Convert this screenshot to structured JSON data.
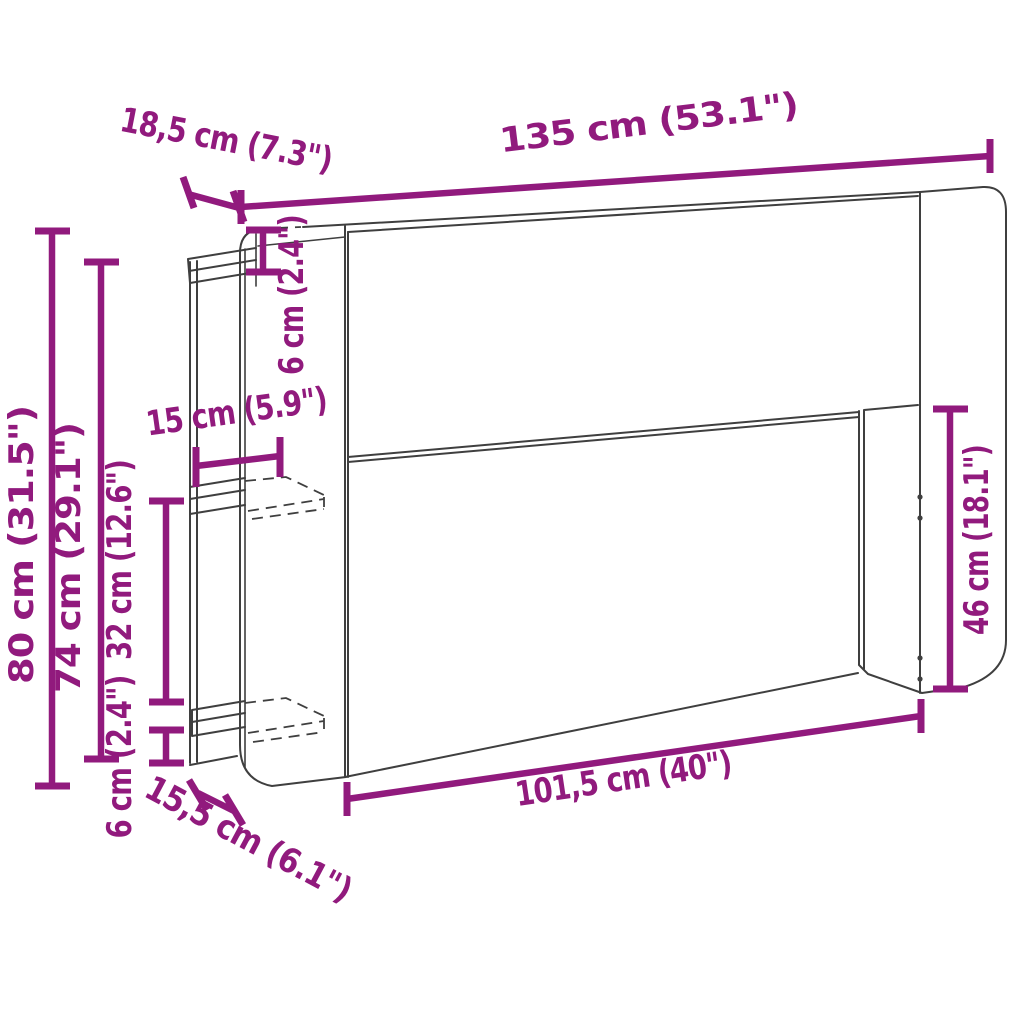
{
  "diagram": {
    "type": "furniture-dimension-diagram",
    "product": "headboard with storage shelves",
    "accent_color": "#911a7d",
    "outline_color": "#3f3f3f",
    "background_color": "#ffffff",
    "dimensions": {
      "overall_width": {
        "label": "135 cm (53.1\")",
        "cm": 135,
        "inches": 53.1
      },
      "top_depth": {
        "label": "18,5 cm (7.3\")",
        "cm": 18.5,
        "inches": 7.3
      },
      "top_thickness": {
        "label": "6 cm (2.4\")",
        "cm": 6,
        "inches": 2.4
      },
      "overall_height": {
        "label": "80 cm (31.5\")",
        "cm": 80,
        "inches": 31.5
      },
      "front_rail_height": {
        "label": "74 cm (29.1\")",
        "cm": 74,
        "inches": 29.1
      },
      "shelf_depth": {
        "label": "15 cm (5.9\")",
        "cm": 15,
        "inches": 5.9
      },
      "shelf_spacing": {
        "label": "32 cm (12.6\")",
        "cm": 32,
        "inches": 12.6
      },
      "shelf_thickness": {
        "label": "6 cm (2.4\")",
        "cm": 6,
        "inches": 2.4
      },
      "bottom_depth": {
        "label": "15,5 cm (6.1\")",
        "cm": 15.5,
        "inches": 6.1
      },
      "inner_width": {
        "label": "101,5 cm (40\")",
        "cm": 101.5,
        "inches": 40
      },
      "side_panel_height": {
        "label": "46 cm (18.1\")",
        "cm": 46,
        "inches": 18.1
      }
    }
  }
}
